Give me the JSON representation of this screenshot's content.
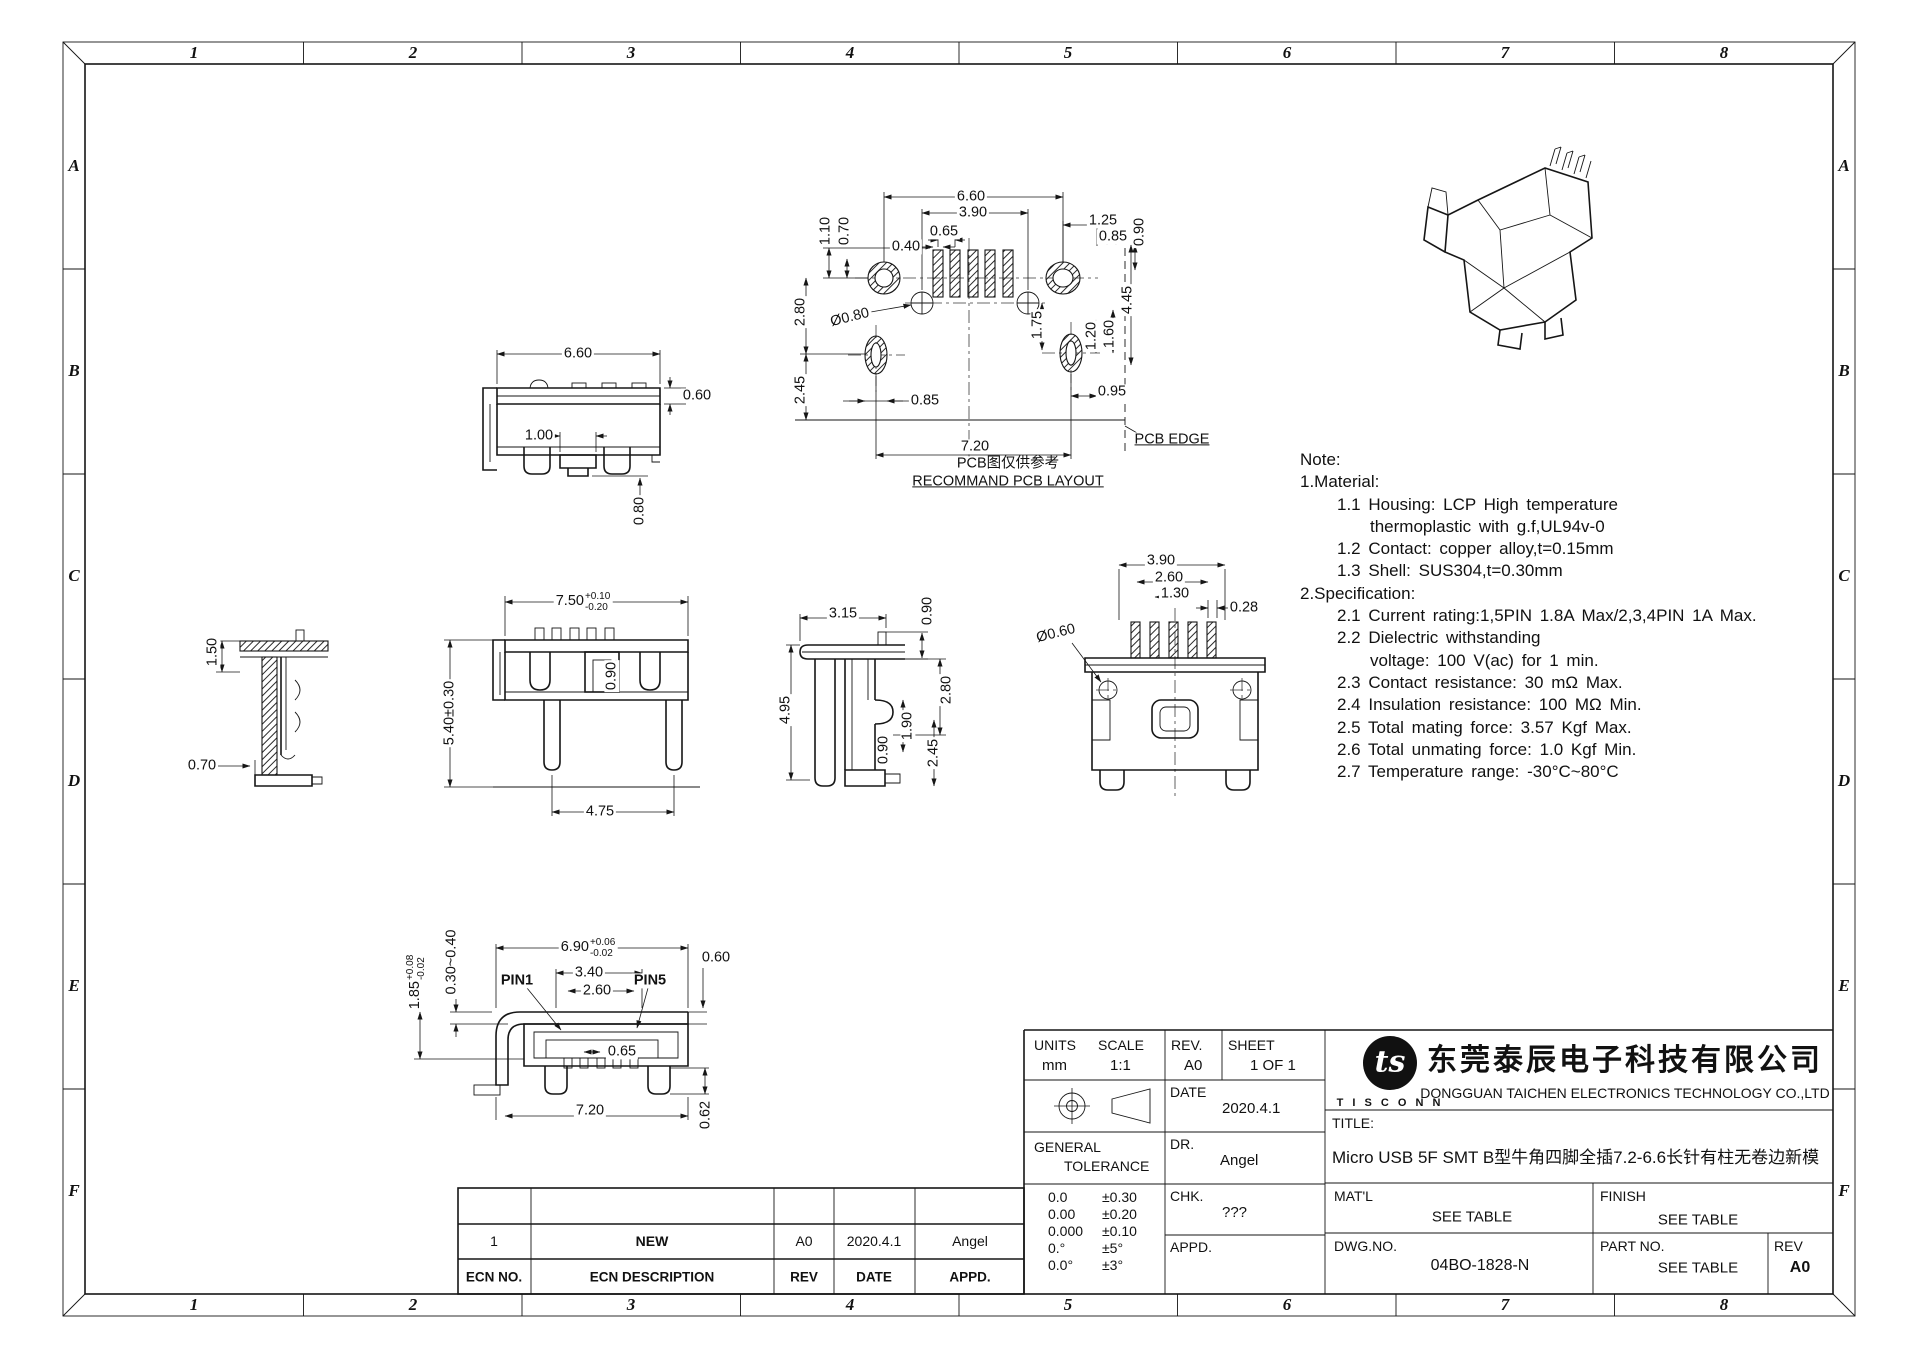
{
  "sheet": {
    "zone_cols": [
      "1",
      "2",
      "3",
      "4",
      "5",
      "6",
      "7",
      "8"
    ],
    "zone_rows": [
      "A",
      "B",
      "C",
      "D",
      "E",
      "F"
    ]
  },
  "notes": {
    "heading": "Note:",
    "lines": [
      "1.Material:",
      "1.1  Housing:  LCP  High  temperature",
      "thermoplastic  with  g.f,UL94v-0",
      "1.2  Contact:  copper  alloy,t=0.15mm",
      "1.3  Shell:  SUS304,t=0.30mm",
      "2.Specification:",
      "2.1  Current  rating:1,5PIN  1.8A  Max/2,3,4PIN  1A  Max.",
      "2.2  Dielectric  withstanding",
      "voltage:  100  V(ac)  for  1  min.",
      "2.3  Contact  resistance:  30  mΩ  Max.",
      "2.4  Insulation  resistance:  100  MΩ  Min.",
      "2.5  Total  mating  force:  3.57  Kgf  Max.",
      "2.6  Total  unmating  force:  1.0  Kgf  Min.",
      "2.7  Temperature  range:  -30°C~80°C"
    ]
  },
  "views": {
    "front_top": {
      "w": "6.60",
      "lip": "0.60",
      "slot": "1.00",
      "tail": "0.80"
    },
    "side_left": {
      "plate": "1.50",
      "base": "0.70"
    },
    "front_mid": {
      "w_base": "7.50",
      "w_up": "+0.10",
      "w_dn": "-0.20",
      "step": "0.90",
      "h": "5.40±0.30",
      "feet": "4.75"
    },
    "side_mid": {
      "w": "3.15",
      "pin": "0.90",
      "depth": "2.80",
      "h": "4.95",
      "leg": "1.90",
      "foot": "0.90",
      "tail": "2.45"
    },
    "back_right": {
      "span": "3.90",
      "inner": "2.60",
      "pitch": "1.30",
      "pin_w": "0.28",
      "hole": "Ø0.60"
    },
    "pcb": {
      "w": "6.60",
      "span": "3.90",
      "pitch": "0.65",
      "pad_w": "0.40",
      "off_a": "1.10",
      "off_b": "0.70",
      "row_a": "2.80",
      "hole": "Ø0.80",
      "drop": "1.75",
      "e1": "1.25",
      "e2": "0.85",
      "e3": "0.90",
      "v1": "1.20",
      "v2": "1.60",
      "v3": "4.45",
      "row_b": "2.45",
      "slot": "0.85",
      "e4": "0.95",
      "total": "7.20",
      "edge": "PCB EDGE",
      "cap_cn": "PCB图仅供参考",
      "cap_en": "RECOMMAND PCB LAYOUT"
    },
    "bottom": {
      "w_base": "6.90",
      "w_up": "+0.06",
      "w_dn": "-0.02",
      "lip": "0.30~0.40",
      "h_base": "1.85",
      "h_up": "+0.08",
      "h_dn": "-0.02",
      "pin1": "PIN1",
      "pin5": "PIN5",
      "mouth": "3.40",
      "span": "2.60",
      "pitch": "0.65",
      "edge": "0.60",
      "total": "7.20",
      "foot": "0.62"
    }
  },
  "title_block": {
    "units_label": "UNITS",
    "units_value": "mm",
    "scale_label": "SCALE",
    "scale_value": "1:1",
    "rev_label": "REV.",
    "rev_value": "A0",
    "sheet_label": "SHEET",
    "sheet_value": "1 OF 1",
    "date_label": "DATE",
    "date_value": "2020.4.1",
    "dr_label": "DR.",
    "dr_value": "Angel",
    "chk_label": "CHK.",
    "chk_value": "???",
    "appd_label": "APPD.",
    "appd_value": "",
    "general_l1": "GENERAL",
    "general_l2": "TOLERANCE",
    "tolerances": [
      [
        "0.0",
        "±0.30"
      ],
      [
        "0.00",
        "±0.20"
      ],
      [
        "0.000",
        "±0.10"
      ],
      [
        "0.°",
        "±5°"
      ],
      [
        "0.0°",
        "±3°"
      ]
    ],
    "logo_text": "ts",
    "logo_sub": "T I S C O N N",
    "company_cn": "东莞泰辰电子科技有限公司",
    "company_en": "DONGGUAN TAICHEN ELECTRONICS TECHNOLOGY CO.,LTD",
    "title_label": "TITLE:",
    "title_value": "Micro USB 5F SMT B型牛角四脚全插7.2-6.6长针有柱无卷边新模",
    "matl_label": "MAT'L",
    "matl_value": "SEE TABLE",
    "finish_label": "FINISH",
    "finish_value": "SEE TABLE",
    "dwg_label": "DWG.NO.",
    "dwg_value": "04BO-1828-N",
    "part_label": "PART NO.",
    "part_value": "SEE TABLE",
    "rev2_label": "REV",
    "rev2_value": "A0"
  },
  "ecn": {
    "headers": [
      "ECN NO.",
      "ECN  DESCRIPTION",
      "REV",
      "DATE",
      "APPD."
    ],
    "row": [
      "1",
      "NEW",
      "A0",
      "2020.4.1",
      "Angel"
    ]
  }
}
